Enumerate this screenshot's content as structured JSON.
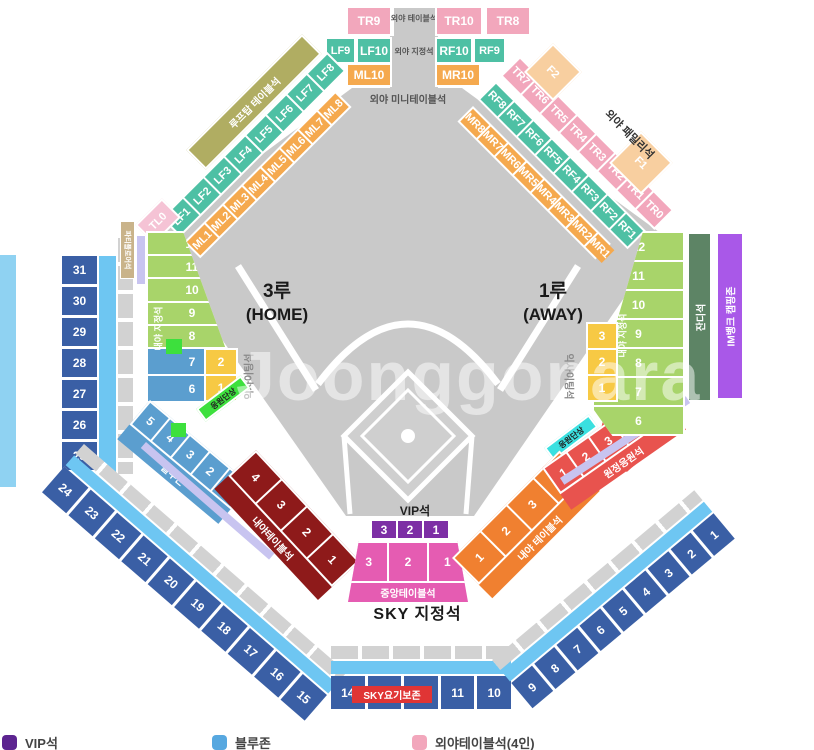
{
  "colors": {
    "field_gray": "#c9c9c9",
    "walkway_gray": "#d2d2d2",
    "outfield_table_pink": "#f2a7bc",
    "outfield_reserved_green": "#4ec0a4",
    "outfield_mini_orange": "#f5a94e",
    "rooftop_olive": "#b0ad62",
    "family_peach": "#f8cfa0",
    "party_floor_tan": "#c9b38a",
    "infield_reserved_green": "#a8d46a",
    "grass_green": "#5d8465",
    "camping_purple": "#a958e8",
    "exciting_yellow": "#f7c944",
    "bluezone_blue": "#5b9ecf",
    "cheer_stage_green": "#3de03d",
    "cheer_stage_cyan": "#3ae0e0",
    "away_cheer_red": "#e8534e",
    "infield_table_orange": "#f08030",
    "infield_table_darkred": "#8e1a1a",
    "vip_purple": "#7d2fa5",
    "center_table_magenta": "#e55cb2",
    "sky_dark_blue": "#3a5fa5",
    "sky_light_blue": "#6ec6f2",
    "outer_band_blue": "#8fd2f2",
    "lavender": "#c8c4f0",
    "yogibo_red": "#e03535"
  },
  "field": {
    "third_base": "3루",
    "third_base_sub": "(HOME)",
    "first_base": "1루",
    "first_base_sub": "(AWAY)",
    "vip_label": "VIP석",
    "watermark": "Joonggonara"
  },
  "outfield": {
    "table_label": "외야 테이블석",
    "reserved_label": "외야 지정석",
    "mini_table_label": "외야 미니테이블석",
    "family_label": "외야 패밀리석",
    "rooftop_label": "루프탑 테이블석",
    "tr_top": [
      "TR9",
      "TR10",
      "TR8"
    ],
    "lf_top": [
      "LF9",
      "LF10"
    ],
    "rf_top": [
      "RF10",
      "RF9"
    ],
    "ml_top": [
      "ML10"
    ],
    "mr_top": [
      "MR10"
    ],
    "lf_diag": [
      "LF1",
      "LF2",
      "LF3",
      "LF4",
      "LF5",
      "LF6",
      "LF7",
      "LF8"
    ],
    "ml_diag": [
      "ML1",
      "ML2",
      "ML3",
      "ML4",
      "ML5",
      "ML6",
      "ML7",
      "ML8"
    ],
    "tl0": "TL0",
    "tr_diag": [
      "TR7",
      "TR6",
      "TR5",
      "TR4",
      "TR3",
      "TR2",
      "TR1",
      "TR0"
    ],
    "rf_diag": [
      "RF8",
      "RF7",
      "RF6",
      "RF5",
      "RF4",
      "RF3",
      "RF2",
      "RF1"
    ],
    "mr_diag": [
      "MR8",
      "MR7",
      "MR6",
      "MR5",
      "MR4",
      "MR3",
      "MR2",
      "MR1"
    ],
    "family_sections": [
      "F2",
      "F1"
    ]
  },
  "right_wing": {
    "grass_label": "잔디석",
    "camping_label": "IM뱅크 캠핑존"
  },
  "left_wing": {
    "party_floor_label": "파티플로어석"
  },
  "infield": {
    "reserved_label_left": "내야 지정석",
    "reserved_label_right": "내야 지정석",
    "left_fan_green": [
      "12",
      "11",
      "10",
      "9",
      "8"
    ],
    "left_fan_blue": [
      "7",
      "6"
    ],
    "left_blue_band": [
      "5",
      "4",
      "3",
      "2",
      "1"
    ],
    "bluezone_label": "블루존",
    "left_yellow": [
      "2",
      "1"
    ],
    "right_yellow": [
      "3",
      "2",
      "1"
    ],
    "exciting_label_left": "익사이팅석",
    "exciting_label_right": "익사이팅석",
    "cheer_stage_left": "응원단상",
    "cheer_stage_right": "응원단상",
    "right_fan_green": [
      "12",
      "11",
      "10",
      "9",
      "8",
      "7",
      "6"
    ],
    "away_cheer_label": "원정응원석",
    "away_cheer_sections": [
      "1",
      "2",
      "3",
      "4",
      "5"
    ],
    "table_left_label": "내야테이블석",
    "table_left_sections": [
      "4",
      "3",
      "2",
      "1"
    ],
    "table_right_label": "내야 테이블석",
    "table_right_sections": [
      "1",
      "2",
      "3",
      "4"
    ],
    "vip_sections": [
      "3",
      "2",
      "1"
    ],
    "center_table_label": "중앙테이블석",
    "center_table_sections": [
      "3",
      "2",
      "1"
    ]
  },
  "upper_deck": {
    "sky_label": "SKY 지정석",
    "yogibo_label": "SKY요기보존",
    "left_column": [
      "31",
      "30",
      "29",
      "28",
      "27",
      "26",
      "25"
    ],
    "left_arc": [
      "24",
      "23",
      "22",
      "21",
      "20",
      "19",
      "18",
      "17",
      "16",
      "15"
    ],
    "bottom_row": [
      "14",
      "13",
      "12",
      "11",
      "10"
    ],
    "right_arc": [
      "9",
      "8",
      "7",
      "6",
      "5",
      "4",
      "3",
      "2",
      "1"
    ]
  },
  "legend": {
    "items": [
      {
        "label": "VIP석",
        "color": "#5c2490"
      },
      {
        "label": "블루존",
        "color": "#57a8e0"
      },
      {
        "label": "외야테이블석(4인)",
        "color": "#f2a7bc"
      }
    ]
  }
}
